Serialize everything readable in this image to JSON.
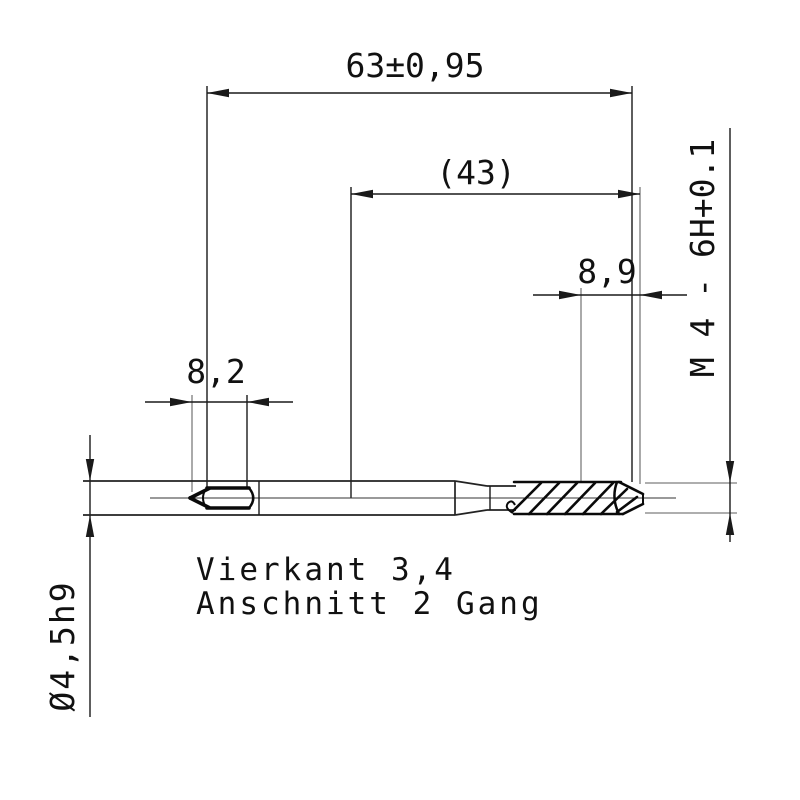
{
  "drawing": {
    "type": "technical-drawing-machine-tap",
    "dimensions": {
      "overall_length": "63±0,95",
      "intermediate_length_ref": "(43)",
      "thread_chamfer_length": "8,9",
      "square_length": "8,2",
      "thread_spec": "M 4 - 6H+0.1",
      "shank_diameter": "Ø4,5h9"
    },
    "notes": {
      "line1": "Vierkant 3,4",
      "line2": "Anschnitt 2 Gang"
    },
    "colors": {
      "line": "#1a1a1a",
      "extension_line": "#7d7d7d",
      "background": "#ffffff"
    }
  }
}
